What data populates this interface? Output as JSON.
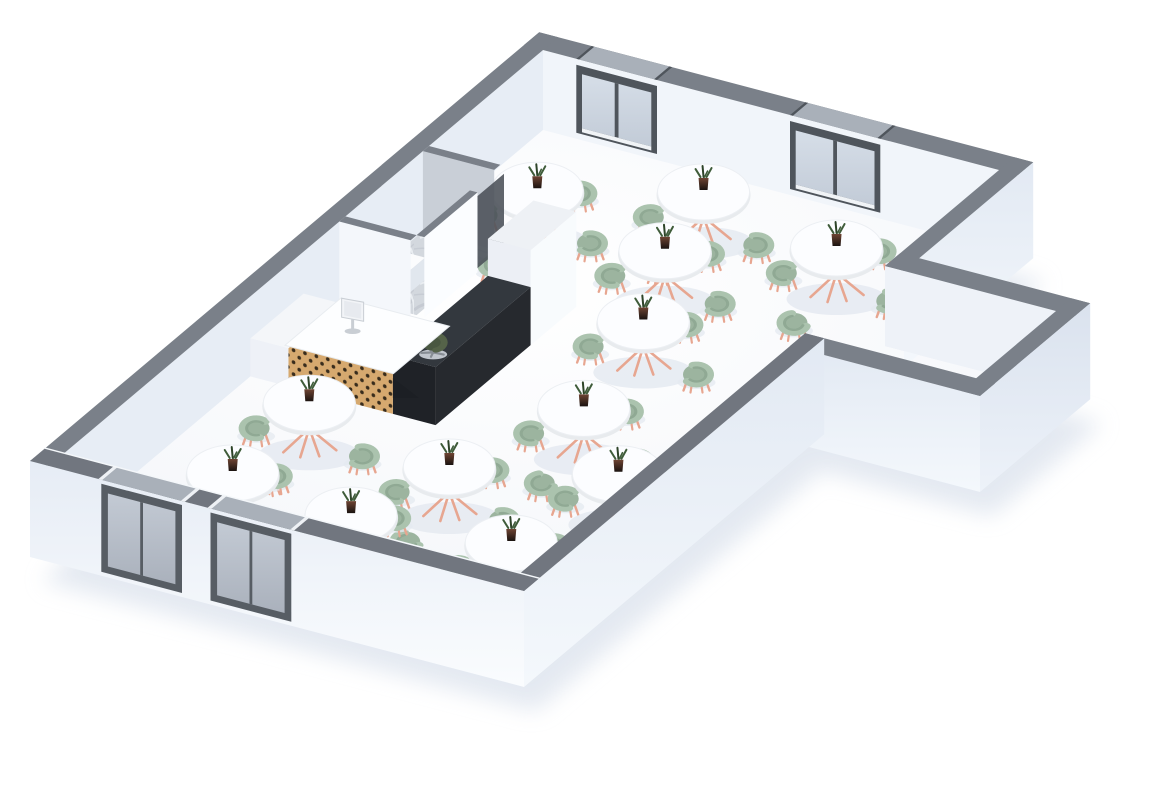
{
  "scene": {
    "label": "3D isometric floor plan rendering of a cafe restaurant dining hall with round tables, sage green tub chairs, reception counter and marble back room",
    "type": "3d-floor-plan-render",
    "canvas": {
      "width": 1170,
      "height": 798
    },
    "projection": {
      "origin": [
        543,
        130
      ],
      "ux": [
        0.95,
        0.25
      ],
      "vx": [
        -0.76,
        0.64
      ]
    },
    "style": {
      "wall_h": 80,
      "base": 16,
      "band_t": 20,
      "table_rx": 46,
      "table_ry": 28,
      "table_h": 39,
      "chair_r": 13.5,
      "chair_squash": 0.74,
      "chair_offset": 56
    },
    "hall": {
      "u": 480,
      "v": 630
    },
    "extension": {
      "u0": 480,
      "u1": 660,
      "v0": 150,
      "v1": 255,
      "contents": "empty"
    },
    "windows": [
      {
        "id": "window-a",
        "wall": "ne",
        "u0": 35,
        "u1": 120,
        "panes": 2
      },
      {
        "id": "window-b",
        "wall": "ne",
        "u0": 260,
        "u1": 355,
        "panes": 2
      }
    ],
    "doors": [
      {
        "id": "door-1",
        "wall": "sw",
        "u0": 55,
        "u1": 140,
        "glazed": true
      },
      {
        "id": "door-2",
        "wall": "sw",
        "u0": 170,
        "u1": 255,
        "glazed": true
      }
    ],
    "back_room": {
      "floor": "marble",
      "rect": {
        "u0": 0,
        "v0": 150,
        "u1": 75,
        "v1": 260
      },
      "doorway": {
        "v0": 150,
        "v1": 190
      },
      "basin": {
        "u0": 18,
        "v0": 215,
        "u1": 48,
        "v1": 252,
        "h": 22
      }
    },
    "counter": {
      "pillar": {
        "u0": 150,
        "v0": 200,
        "u1": 195,
        "v1": 260,
        "h": 95
      },
      "bar": {
        "u0": 150,
        "v0": 260,
        "u1": 195,
        "v1": 385,
        "h": 58
      },
      "desk": {
        "u0": 40,
        "v0": 315,
        "u1": 150,
        "v1": 385,
        "h": 42,
        "front": "wood-dots"
      },
      "cabinet": {
        "u0": 0,
        "v0": 315,
        "u1": 40,
        "v1": 385,
        "h": 38
      },
      "monitor": {
        "u": 78,
        "v": 348
      },
      "office_chair": {
        "u": 118,
        "v": 292
      }
    },
    "tables": [
      {
        "id": "t1",
        "u": 90,
        "v": 120,
        "chairs": [
          "N",
          "E",
          "S",
          "W"
        ]
      },
      {
        "id": "t2",
        "u": 225,
        "v": 70,
        "chairs": [
          "W",
          "E",
          "S"
        ]
      },
      {
        "id": "t3",
        "u": 385,
        "v": 95,
        "chairs": [
          "N",
          "E",
          "S",
          "W"
        ]
      },
      {
        "id": "t4",
        "u": 250,
        "v": 152,
        "chairs": [
          "N",
          "E",
          "S",
          "W"
        ]
      },
      {
        "id": "t5",
        "u": 300,
        "v": 243,
        "chairs": [
          "N",
          "E",
          "S",
          "W"
        ]
      },
      {
        "id": "t6",
        "u": 335,
        "v": 365,
        "chairs": [
          "N",
          "E",
          "S",
          "W"
        ]
      },
      {
        "id": "t7",
        "u": 110,
        "v": 445,
        "chairs": [
          "W",
          "E",
          "S"
        ]
      },
      {
        "id": "t8",
        "u": 283,
        "v": 477,
        "chairs": [
          "N",
          "E",
          "S",
          "W"
        ]
      },
      {
        "id": "t9",
        "u": 115,
        "v": 552,
        "chairs": [
          "N",
          "E",
          "S",
          "W"
        ]
      },
      {
        "id": "t10",
        "u": 250,
        "v": 565,
        "chairs": [
          "N",
          "E",
          "S",
          "W"
        ]
      },
      {
        "id": "t11",
        "u": 405,
        "v": 548,
        "chairs": [
          "N",
          "E",
          "S",
          "W"
        ]
      },
      {
        "id": "t12",
        "u": 425,
        "v": 432,
        "chairs": [
          "N",
          "E",
          "S",
          "W"
        ]
      }
    ],
    "furniture_counts": {
      "tables": 12,
      "dining_chairs": 46,
      "office_chairs": 1,
      "windows": 2,
      "glass_doors": 2,
      "plants": 12
    },
    "colors": {
      "page_bg": "#ffffff",
      "ground_shadow": "#d6deea",
      "floor_light": "#ffffff",
      "floor_shade": "#f0f3f8",
      "band": "#7a8089",
      "band_near": "#71767f",
      "band_slot": "#a9b0b9",
      "band_lip": "#f4f7fa",
      "wall_ne_face": "#f1f5fa",
      "wall_nw_face": "#e7edf5",
      "ext_nw_face": "#eef2f8",
      "ext_end_face": "#e9eef6",
      "ext_face_top": "#e6ecf5",
      "ext_face_bot": "#fafcfe",
      "se_face_top": "#e2e9f3",
      "se_face_bot": "#f4f8fc",
      "end_face_top": "#dae2ee",
      "end_face_bot": "#edf2f9",
      "window_frame": "#4f555c",
      "glass_top": "#d6dee8",
      "glass_bot": "#c2cbd7",
      "sill": "#f0f3f6",
      "door_frame": "#575d64",
      "door_glass_top": "#c3cad4",
      "door_glass_bot": "#aab1bc",
      "jamb": "#eef1f5",
      "marble_base": "#d3d8de",
      "marble_vein_dark": "#bfc5cd",
      "marble_vein_light": "#e9edf1",
      "partition_face": "#fbfdff",
      "partition_face_sw": "#f4f7fb",
      "partition_inner": "#c9cfd7",
      "doorway_shadow": "#4a5058",
      "basin_top": "#fbfcfd",
      "basin_front": "#edf0f5",
      "basin_side": "#e1e7ee",
      "pillar_top": "#eef1f5",
      "pillar_face_u": "#f8fbfd",
      "pillar_face_v": "#eceff5",
      "bar_top": "#33383e",
      "bar_face_u": "#26292e",
      "bar_face_v": "#1f2227",
      "bar_wedge": "#1c1f24",
      "wood_base": "#d6a96f",
      "wood_dot": "#382c1c",
      "desk_top": "#fdfeff",
      "desk_top_edge": "#e8ecf0",
      "cabinet_top": "#f4f6f9",
      "cabinet_face": "#eef1f7",
      "monitor_body": "#f2f4f7",
      "monitor_screen": "#e7eaef",
      "monitor_stand": "#c9ced4",
      "office_seat": "#495741",
      "office_back": "#556349",
      "office_base": "#878d94",
      "table_top": "#fcfdff",
      "table_top_edge": "#eceff3",
      "table_rim": "#e8ebee",
      "table_stem": "#d9d5d0",
      "copper": "#e7a690",
      "chair_seat": "#9cb49f",
      "chair_back": "#abc3ae",
      "chair_back_shade": "#8ba48f",
      "furn_shadow": "#e4e9f0",
      "pot_top": "#6e4433",
      "pot_bot": "#1a1310",
      "leaf": "#3f5c3a",
      "leaf_dark": "#2e4429"
    }
  }
}
